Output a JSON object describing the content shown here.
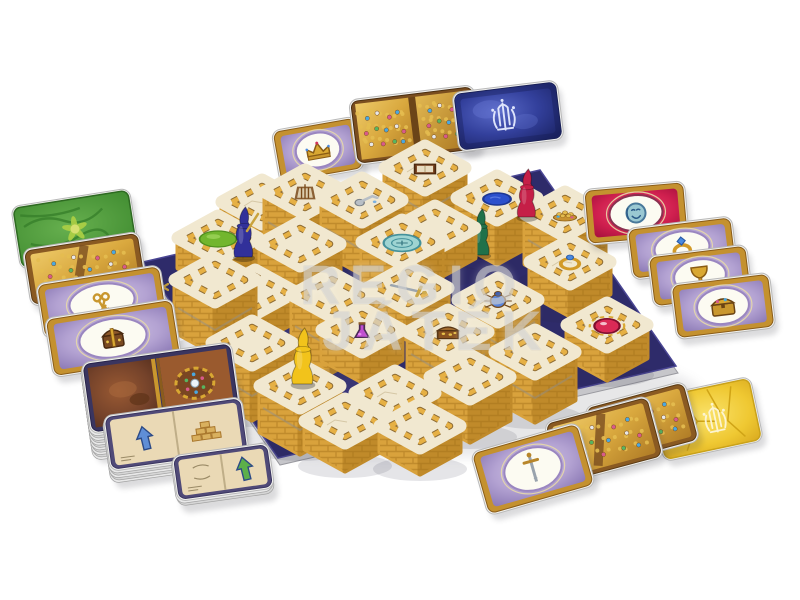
{
  "page": {
    "background": "#ffffff",
    "description": "Labyrinth 3D board game product photo: brick maze tiles on a navy mat, four wizard pawns and treasure cards"
  },
  "watermark": {
    "line1": "REGIO",
    "line2": "JÁTÉK"
  },
  "palette": {
    "tile_top": "#f1e8d0",
    "wall_light": "#d9a23c",
    "wall_dark": "#c austin08a2a",
    "brick_line": "#a6741c",
    "trim_gold": "#e6b044",
    "trim_dark": "#7a5317",
    "mat": "#2e2b6a",
    "mat_mottle": "#56519e",
    "rim": "#c6c6ca",
    "gold_symbol": "#c9a23c",
    "card_gold_border": "#c4912f"
  },
  "board": {
    "corners": {
      "left": [
        143,
        262
      ],
      "top": [
        540,
        170
      ],
      "right": [
        676,
        366
      ],
      "bottom": [
        278,
        458
      ]
    },
    "edge_marks": [
      {
        "t": "x",
        "x": 163,
        "y": 287
      },
      {
        "t": "x",
        "x": 208,
        "y": 336
      },
      {
        "t": "tri",
        "x": 224,
        "y": 366,
        "r": 62
      },
      {
        "t": "x",
        "x": 271,
        "y": 425
      },
      {
        "t": "x",
        "x": 399,
        "y": 398
      },
      {
        "t": "tri",
        "x": 543,
        "y": 387,
        "r": -22
      },
      {
        "t": "x",
        "x": 612,
        "y": 369
      }
    ],
    "mottles": [
      [
        265,
        330,
        55,
        16
      ],
      [
        350,
        390,
        75,
        18
      ],
      [
        480,
        390,
        70,
        15
      ],
      [
        560,
        350,
        45,
        12
      ],
      [
        210,
        300,
        35,
        10
      ]
    ],
    "tiles": [
      [
        262,
        238,
        36,
        null
      ],
      [
        305,
        246,
        54,
        "cage"
      ],
      [
        362,
        252,
        52,
        "tap"
      ],
      [
        425,
        214,
        46,
        "book"
      ],
      [
        497,
        242,
        44,
        "pond"
      ],
      [
        565,
        264,
        50,
        "goldpile"
      ],
      [
        218,
        268,
        30,
        "greenpad"
      ],
      [
        435,
        258,
        30,
        null
      ],
      [
        402,
        284,
        42,
        "teal"
      ],
      [
        570,
        294,
        32,
        "ring"
      ],
      [
        300,
        302,
        58,
        null
      ],
      [
        408,
        318,
        30,
        "sword"
      ],
      [
        255,
        322,
        30,
        null
      ],
      [
        215,
        332,
        52,
        null
      ],
      [
        332,
        350,
        55,
        null
      ],
      [
        498,
        346,
        46,
        "scarab"
      ],
      [
        607,
        358,
        33,
        "redgem"
      ],
      [
        362,
        360,
        30,
        "potion"
      ],
      [
        448,
        378,
        46,
        "chest"
      ],
      [
        252,
        398,
        55,
        null
      ],
      [
        535,
        400,
        48,
        null
      ],
      [
        395,
        426,
        33,
        null
      ],
      [
        470,
        420,
        43,
        null
      ],
      [
        300,
        432,
        46,
        null
      ],
      [
        345,
        449,
        28,
        null
      ],
      [
        420,
        452,
        26,
        null
      ]
    ]
  },
  "pawns": [
    {
      "name": "blue",
      "hex": "#31309a",
      "x": 244,
      "y": 257,
      "h": 50,
      "z": 273,
      "staff": true
    },
    {
      "name": "red",
      "hex": "#c51f47",
      "x": 527,
      "y": 217,
      "h": 48,
      "z": 266,
      "staff": false
    },
    {
      "name": "green",
      "hex": "#20714a",
      "x": 481,
      "y": 255,
      "h": 46,
      "z": 256,
      "staff": false
    },
    {
      "name": "yellow",
      "hex": "#f2c31b",
      "x": 303,
      "y": 384,
      "h": 56,
      "z": 436,
      "staff": false
    }
  ],
  "cards": [
    {
      "name": "treasure-card-crown",
      "kind": "purple",
      "icon": "crown",
      "x": 318,
      "y": 150,
      "w": 86,
      "h": 54,
      "rot": -10,
      "layer": "back"
    },
    {
      "name": "gold-treasure-spread",
      "kind": "goldspread",
      "x": 415,
      "y": 125,
      "w": 126,
      "h": 66,
      "rot": -7,
      "layer": "back"
    },
    {
      "name": "blue-card-back",
      "kind": "blueback",
      "x": 508,
      "y": 116,
      "w": 106,
      "h": 60,
      "rot": -7,
      "layer": "back"
    },
    {
      "name": "green-card-back",
      "kind": "greenback",
      "x": 75,
      "y": 229,
      "w": 120,
      "h": 64,
      "rot": -9,
      "layer": "front"
    },
    {
      "name": "gold-treasure-card-left",
      "kind": "goldpile",
      "x": 85,
      "y": 269,
      "w": 118,
      "h": 58,
      "rot": -9,
      "layer": "front"
    },
    {
      "name": "treasure-card-keys",
      "kind": "purple",
      "icon": "keys",
      "x": 102,
      "y": 302,
      "w": 126,
      "h": 56,
      "rot": -9,
      "layer": "front"
    },
    {
      "name": "treasure-card-chest-brown",
      "kind": "purple",
      "icon": "idol",
      "x": 113,
      "y": 338,
      "w": 130,
      "h": 60,
      "rot": -9,
      "layer": "front"
    },
    {
      "name": "building-card-deck",
      "kind": "deckbook",
      "x": 161,
      "y": 388,
      "w": 152,
      "h": 72,
      "rot": -8,
      "stack": 12,
      "layer": "front"
    },
    {
      "name": "building-card-blue-arrow",
      "kind": "book",
      "variant": "pyramid",
      "arrow": "#5f8ed6",
      "x": 176,
      "y": 434,
      "w": 140,
      "h": 56,
      "rot": -8,
      "stack": 6,
      "layer": "front"
    },
    {
      "name": "building-card-green-arrow",
      "kind": "book",
      "variant": "green",
      "arrow": "#5cb04a",
      "x": 223,
      "y": 472,
      "w": 98,
      "h": 46,
      "rot": -8,
      "stack": 3,
      "layer": "front"
    },
    {
      "name": "gold-card-back",
      "kind": "goldback",
      "x": 707,
      "y": 419,
      "w": 102,
      "h": 66,
      "rot": -12,
      "layer": "front"
    },
    {
      "name": "gold-treasure-card-right-b",
      "kind": "goldpile",
      "x": 642,
      "y": 424,
      "w": 104,
      "h": 62,
      "rot": -15,
      "layer": "front"
    },
    {
      "name": "gold-treasure-card-right-a",
      "kind": "goldpile",
      "x": 604,
      "y": 440,
      "w": 108,
      "h": 64,
      "rot": -15,
      "layer": "front"
    },
    {
      "name": "treasure-card-sword",
      "kind": "purple",
      "icon": "sword",
      "x": 533,
      "y": 469,
      "w": 112,
      "h": 66,
      "rot": -16,
      "layer": "front"
    },
    {
      "name": "treasure-card-moon",
      "kind": "red",
      "icon": "moon",
      "x": 636,
      "y": 213,
      "w": 102,
      "h": 56,
      "rot": -5,
      "layer": "front"
    },
    {
      "name": "treasure-card-ring",
      "kind": "purple",
      "icon": "ring",
      "x": 682,
      "y": 248,
      "w": 106,
      "h": 52,
      "rot": -7,
      "layer": "front"
    },
    {
      "name": "treasure-card-goblet",
      "kind": "purple",
      "icon": "goblet",
      "x": 700,
      "y": 276,
      "w": 100,
      "h": 52,
      "rot": -7,
      "layer": "front"
    },
    {
      "name": "treasure-card-chest-gold",
      "kind": "purple",
      "icon": "chestgold",
      "x": 723,
      "y": 306,
      "w": 100,
      "h": 56,
      "rot": -7,
      "layer": "front"
    }
  ]
}
